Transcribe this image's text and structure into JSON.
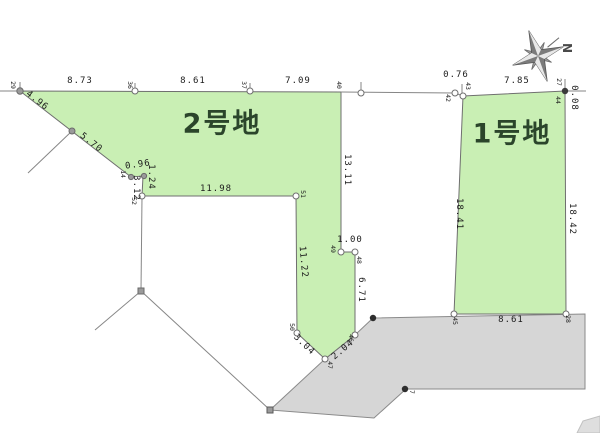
{
  "diagram": {
    "type": "land-plot-survey-map",
    "plots": [
      {
        "id": "plot-2",
        "label": "2号地"
      },
      {
        "id": "plot-1",
        "label": "1号地"
      }
    ],
    "compass": {
      "north_label": "N"
    },
    "colors": {
      "plot_fill": "#c9efb4",
      "road_fill": "#d6d6d6",
      "patch_fill": "#dedede",
      "line": "#7f7f7f",
      "label_text": "#1c1c1c",
      "plot_label_text": "#2b452b"
    },
    "boundary_labels": [
      {
        "t": "8.73",
        "x": 80,
        "y": 81,
        "r": 0
      },
      {
        "t": "8.61",
        "x": 193,
        "y": 81,
        "r": 0
      },
      {
        "t": "7.09",
        "x": 298,
        "y": 81,
        "r": 0
      },
      {
        "t": "0.76",
        "x": 456,
        "y": 75,
        "r": 0
      },
      {
        "t": "7.85",
        "x": 517,
        "y": 81,
        "r": 0
      },
      {
        "t": "4.96",
        "x": 37,
        "y": 101,
        "r": 38
      },
      {
        "t": "5.70",
        "x": 91,
        "y": 143,
        "r": 38
      },
      {
        "t": "0.96",
        "x": 138,
        "y": 165,
        "r": -8
      },
      {
        "t": "1.24",
        "x": 151,
        "y": 177,
        "r": 90
      },
      {
        "t": "3.12",
        "x": 136,
        "y": 188,
        "r": 90
      },
      {
        "t": "13.11",
        "x": 347,
        "y": 170,
        "r": 90
      },
      {
        "t": "1.00",
        "x": 350,
        "y": 240,
        "r": 0
      },
      {
        "t": "6.71",
        "x": 361,
        "y": 290,
        "r": 90
      },
      {
        "t": "11.22",
        "x": 303,
        "y": 262,
        "r": 85
      },
      {
        "t": "11.98",
        "x": 216,
        "y": 189,
        "r": 0
      },
      {
        "t": "3.04",
        "x": 304,
        "y": 345,
        "r": 44
      },
      {
        "t": "2.04",
        "x": 343,
        "y": 350,
        "r": -40
      },
      {
        "t": "18.41",
        "x": 459,
        "y": 214,
        "r": 90
      },
      {
        "t": "18.42",
        "x": 572,
        "y": 219,
        "r": 90
      },
      {
        "t": "8.61",
        "x": 511,
        "y": 320,
        "r": 0
      },
      {
        "t": "0.08",
        "x": 574,
        "y": 98,
        "r": 90
      }
    ],
    "point_labels": [
      {
        "t": "29",
        "x": 13,
        "y": 85,
        "r": 90
      },
      {
        "t": "36",
        "x": 130,
        "y": 85,
        "r": 90
      },
      {
        "t": "37",
        "x": 244,
        "y": 85,
        "r": 90
      },
      {
        "t": "40",
        "x": 339,
        "y": 85,
        "r": 90
      },
      {
        "t": "42",
        "x": 448,
        "y": 98,
        "r": 90
      },
      {
        "t": "43",
        "x": 468,
        "y": 86,
        "r": 90
      },
      {
        "t": "27",
        "x": 559,
        "y": 82,
        "r": 90
      },
      {
        "t": "44",
        "x": 558,
        "y": 100,
        "r": 90
      },
      {
        "t": "14",
        "x": 123,
        "y": 174,
        "r": 90
      },
      {
        "t": "52",
        "x": 134,
        "y": 201,
        "r": 90
      },
      {
        "t": "51",
        "x": 303,
        "y": 194,
        "r": 90
      },
      {
        "t": "50",
        "x": 292,
        "y": 327,
        "r": 90
      },
      {
        "t": "49",
        "x": 333,
        "y": 249,
        "r": 90
      },
      {
        "t": "48",
        "x": 359,
        "y": 260,
        "r": 90
      },
      {
        "t": "46",
        "x": 351,
        "y": 338,
        "r": 90
      },
      {
        "t": "47",
        "x": 330,
        "y": 365,
        "r": 90
      },
      {
        "t": "45",
        "x": 455,
        "y": 321,
        "r": 90
      },
      {
        "t": "28",
        "x": 568,
        "y": 319,
        "r": 90
      },
      {
        "t": "7",
        "x": 412,
        "y": 392,
        "r": 90
      }
    ]
  }
}
